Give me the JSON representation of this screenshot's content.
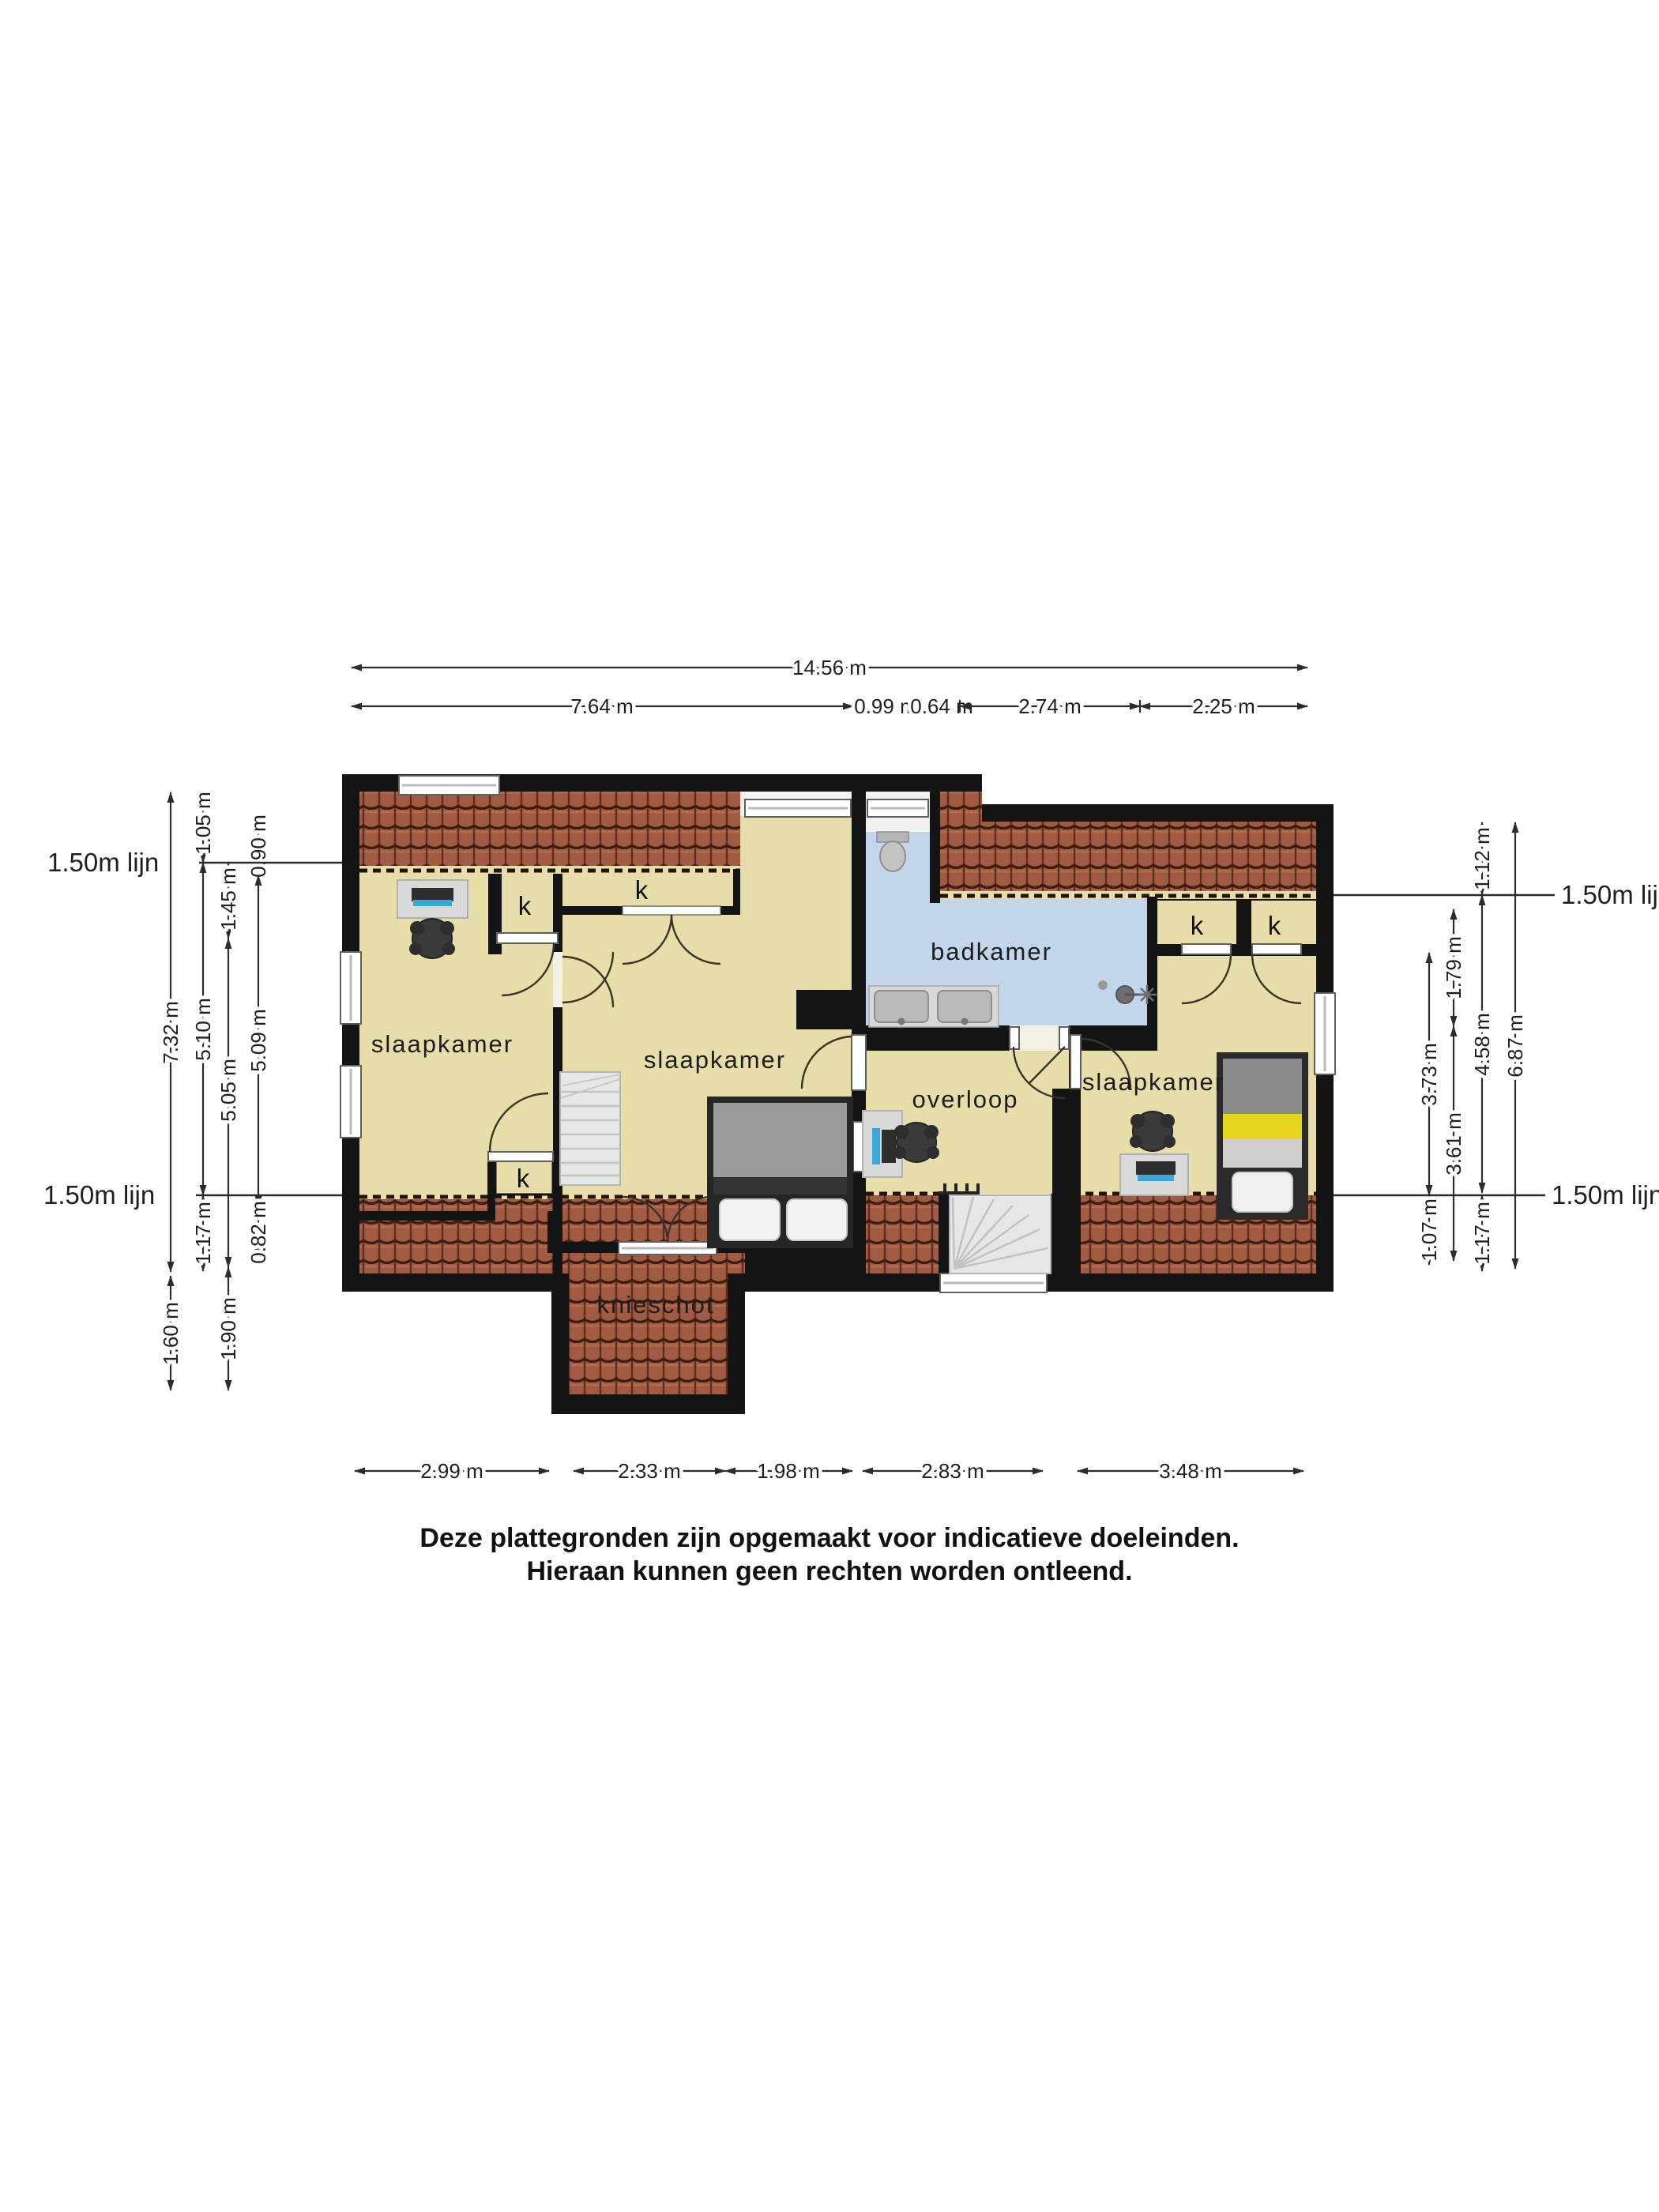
{
  "disclaimer": {
    "line1": "Deze plattegronden zijn opgemaakt voor indicatieve doeleinden.",
    "line2": "Hieraan kunnen geen rechten worden ontleend."
  },
  "labels": {
    "bedroom": "slaapkamer",
    "bathroom": "badkamer",
    "landing": "overloop",
    "knee_wall": "knieschot",
    "closet": "k",
    "line_150": "1.50m lijn"
  },
  "dims": {
    "top_total": "14.56 m",
    "top": [
      "7.64 m",
      "0.99 m",
      "0.64 m",
      "2.74 m",
      "2.25 m"
    ],
    "bottom": [
      "2.99 m",
      "2.33 m",
      "1.98 m",
      "2.83 m",
      "3.48 m"
    ],
    "left": {
      "c1": [
        "7.32 m",
        "1.60 m"
      ],
      "c2": [
        "1.05 m",
        "5.10 m",
        "1.17 m"
      ],
      "c3": [
        "1.45 m",
        "5.05 m",
        "1.90 m"
      ],
      "c4": [
        "0.90 m",
        "5.09 m",
        "0.82 m"
      ]
    },
    "right": {
      "c1": [
        "3.73 m",
        "1.07 m"
      ],
      "c2": [
        "1.79 m",
        "3.61 m"
      ],
      "c3": [
        "1.12 m",
        "4.58 m",
        "1.17 m"
      ],
      "c4": [
        "6.87 m"
      ]
    }
  },
  "colors": {
    "floor": "#e7dda9",
    "bathroom_floor": "#c2d5ea",
    "wall": "#141414",
    "roof_tile": "#a15b43",
    "bed_accent": "#e5d61d",
    "screen_accent": "#38a8d8"
  }
}
